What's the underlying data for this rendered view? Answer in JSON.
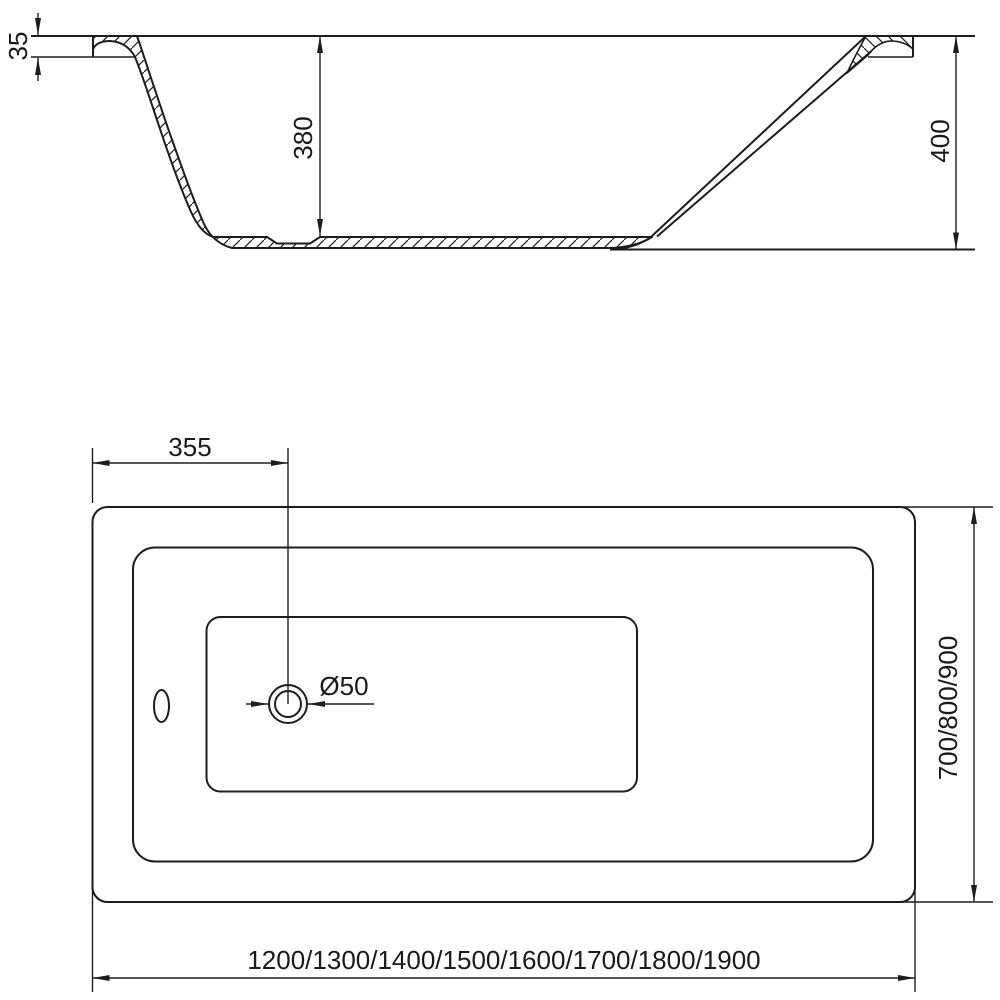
{
  "document": {
    "type": "technical-drawing",
    "subject": "rectangular bathtub dimensional diagram",
    "background_color": "#ffffff",
    "line_color": "#1d1d1d"
  },
  "section_view": {
    "name": "side cross-section",
    "dim_rim_height": "35",
    "dim_inner_depth": "380",
    "dim_total_height": "400"
  },
  "plan_view": {
    "name": "top view",
    "dim_drain_offset": "355",
    "dim_drain_diameter": "Ø50",
    "dim_width_options": "700/800/900",
    "dim_length_options": "1200/1300/1400/1500/1600/1700/1800/1900"
  }
}
